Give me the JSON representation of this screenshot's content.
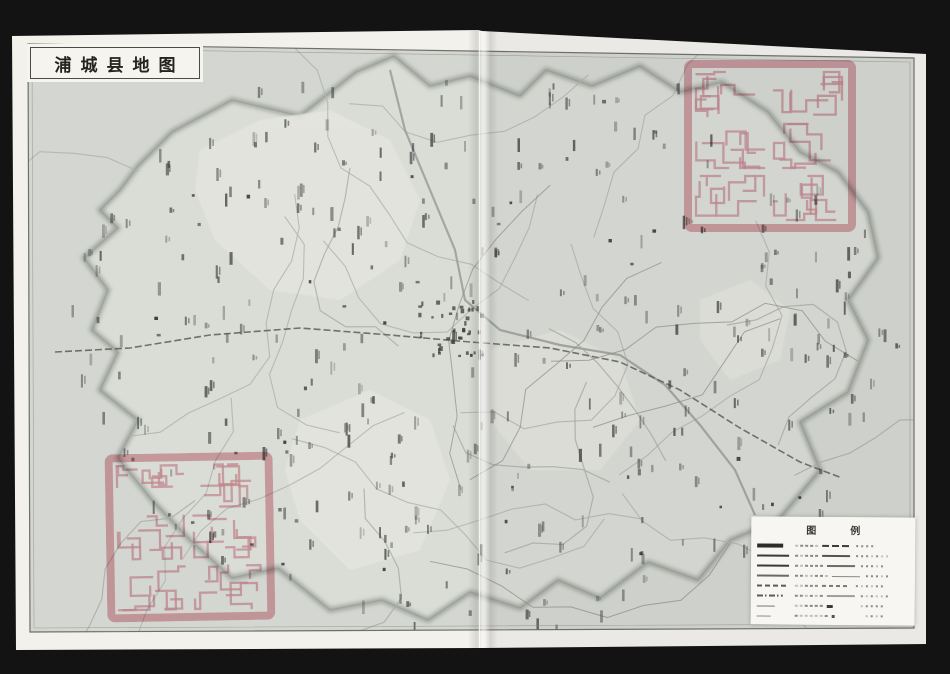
{
  "scene": {
    "description": "Scanned two-page atlas spread showing a county map with collection seals",
    "background_color": "#131313",
    "page_color": "#f3f1ec",
    "map_paper_color": "#d4d6d1",
    "map_light_region_color": "#e4e5df",
    "boundary_fuzzy_color": "#9aa099",
    "label_ink_color": "#3f423f",
    "seal_color": "#dd93a0"
  },
  "title": {
    "text": "浦城县地图"
  },
  "legend": {
    "title_chars": [
      "图",
      "例"
    ],
    "rows": [
      {
        "left_symbol": "town-bold-label",
        "mid_symbol": "railway-triple-dash"
      },
      {
        "left_symbol": "thick-solid-line",
        "mid_symbol": "highway-line"
      },
      {
        "left_symbol": "thick-solid-line",
        "mid_symbol": "road-line"
      },
      {
        "left_symbol": "thin-solid-line",
        "mid_symbol": "path-line"
      },
      {
        "left_symbol": "dashed-line",
        "mid_symbol": "boundary-line"
      },
      {
        "left_symbol": "dot-dash-line",
        "mid_symbol": "river-line"
      },
      {
        "left_symbol": "short-thin-line",
        "mid_symbol": "point-symbol"
      },
      {
        "left_symbol": "fine-line",
        "mid_symbol": "dot-symbol"
      }
    ]
  },
  "seals": {
    "color": "#dd93a0",
    "instances": [
      {
        "position": "top-right",
        "shape": "square",
        "grid": "2x3"
      },
      {
        "position": "bottom-left",
        "shape": "square",
        "grid": "2x3"
      }
    ]
  }
}
